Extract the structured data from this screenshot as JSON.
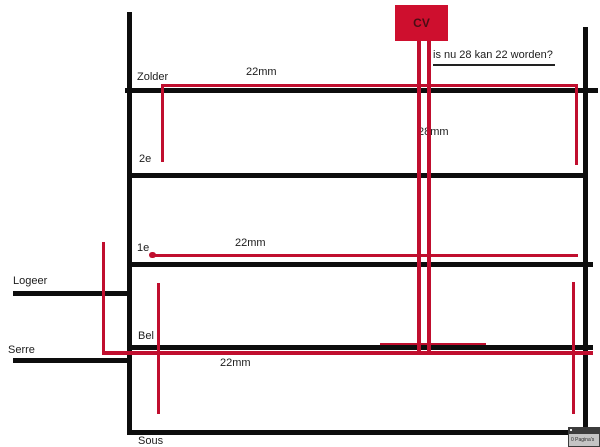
{
  "colors": {
    "pipe_red": "#c00e2e",
    "structure_black": "#0d0d0d",
    "cv_box_fill": "#ce0f2e",
    "cv_label_color": "#4a0d14",
    "text_color": "#1c1c1c"
  },
  "cv_unit": {
    "label": "CV"
  },
  "annotation": {
    "question": "is nu 28 kan 22 worden?"
  },
  "pipe_labels": {
    "zolder_run": "22mm",
    "riser": "28mm",
    "first_floor_run": "22mm",
    "bel_run": "22mm"
  },
  "floor_labels": {
    "zolder": "Zolder",
    "second": "2e",
    "first": "1e",
    "bel": "Bel",
    "sous": "Sous"
  },
  "annex_labels": {
    "logeer": "Logeer",
    "serre": "Serre"
  },
  "badge": {
    "label": "0 Pagina's"
  }
}
